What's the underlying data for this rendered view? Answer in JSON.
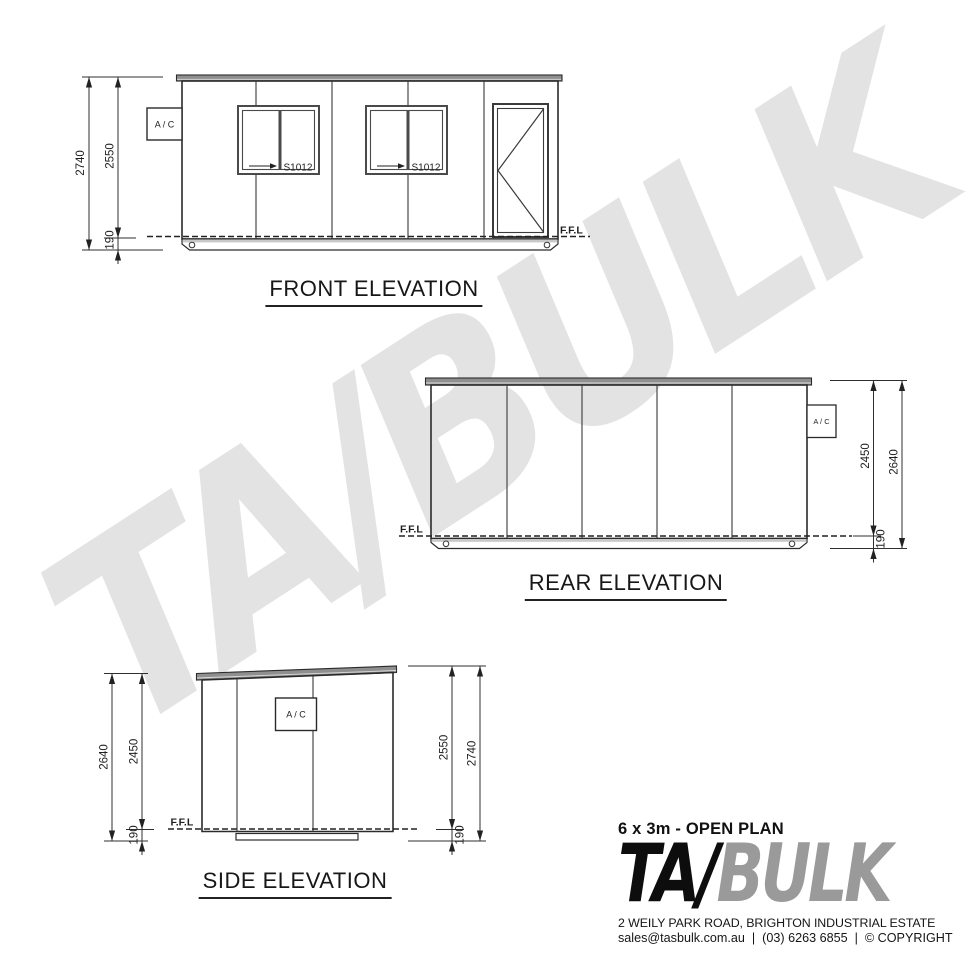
{
  "watermark": {
    "text": "TA/BULK"
  },
  "front": {
    "title": "FRONT ELEVATION",
    "ac": "A / C",
    "ffl": "F.F.L",
    "windows": [
      {
        "label": "S1012"
      },
      {
        "label": "S1012"
      }
    ],
    "dim_overall": "2740",
    "dim_wall": "2550",
    "dim_floor": "190"
  },
  "rear": {
    "title": "REAR ELEVATION",
    "ac": "A / C",
    "ffl": "F.F.L",
    "dim_wall": "2450",
    "dim_overall": "2640",
    "dim_floor": "190"
  },
  "side": {
    "title": "SIDE ELEVATION",
    "ac": "A / C",
    "ffl": "F.F.L",
    "left": {
      "dim_overall": "2640",
      "dim_wall": "2450",
      "dim_floor": "190"
    },
    "right": {
      "dim_wall": "2550",
      "dim_overall": "2740",
      "dim_floor": "190"
    }
  },
  "titleblock": {
    "plan": "6 x 3m - OPEN PLAN",
    "logo_tas": "TA",
    "logo_s": "/",
    "logo_bulk": "BULK",
    "address": "2 WEILY PARK ROAD, BRIGHTON INDUSTRIAL ESTATE",
    "email": "sales@tasbulk.com.au",
    "sep1": "|",
    "phone": "(03) 6263 6855",
    "sep2": "|",
    "copyright": "© COPYRIGHT"
  },
  "colors": {
    "line": "#2b2b2b",
    "roof_fill": "#8f8f8f",
    "watermark": "#e3e3e3",
    "logo_gray": "#9a9a9a"
  }
}
